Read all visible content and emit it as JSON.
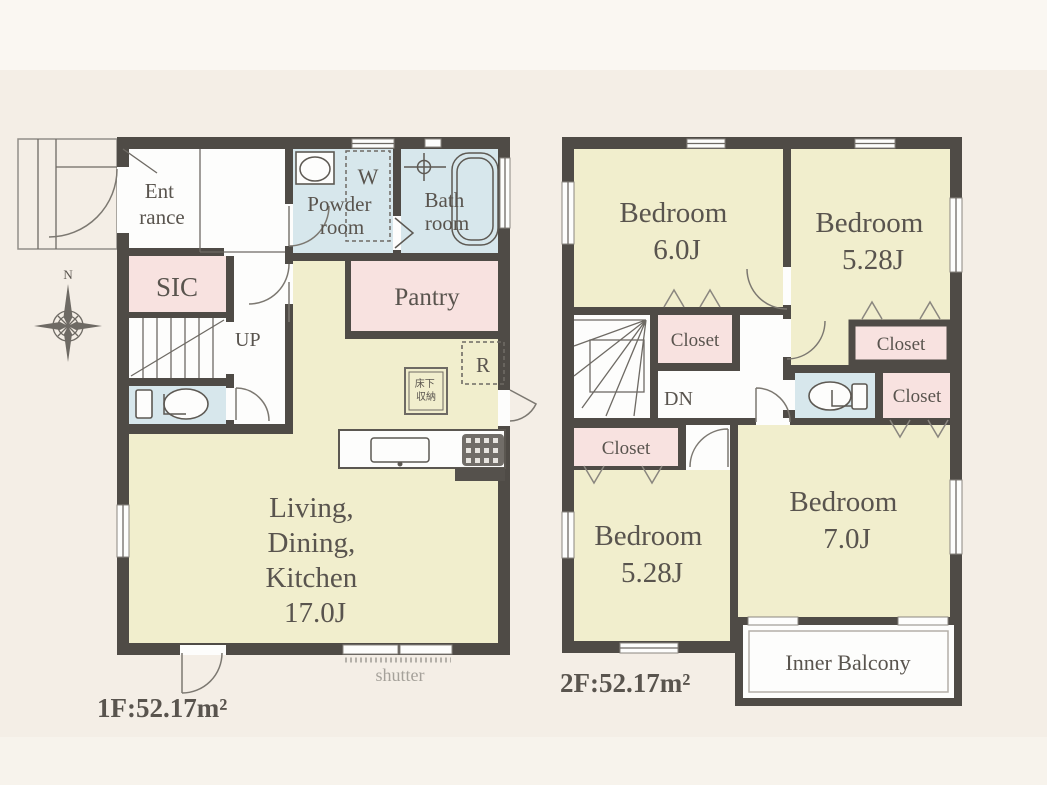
{
  "compass": {
    "north": "N"
  },
  "colors": {
    "wall": "#4f4b46",
    "room_yellow": "#f1eecd",
    "room_pink": "#f8e2e0",
    "room_blue": "#d7e7ec",
    "room_white": "#fdfdfc",
    "background": "#f4eee6",
    "text": "#59544e"
  },
  "fixtures": [
    "compass-rose",
    "toilet",
    "bathtub",
    "sink",
    "washer-space",
    "refrigerator-space",
    "kitchen-counter",
    "gas-stove",
    "floor-storage-hatch",
    "stairs",
    "porch-steps"
  ],
  "floor1": {
    "area_label": "1F:52.17m²",
    "entrance_line1": "Ent",
    "entrance_line2": "rance",
    "sic": "SIC",
    "up": "UP",
    "powder_line1": "Powder",
    "powder_line2": "room",
    "bath_line1": "Bath",
    "bath_line2": "room",
    "pantry": "Pantry",
    "washer": "W",
    "fridge": "R",
    "storage_line1": "床下",
    "storage_line2": "収納",
    "ldk_line1": "Living,",
    "ldk_line2": "Dining,",
    "ldk_line3": "Kitchen",
    "ldk_line4": "17.0J",
    "shutter": "shutter"
  },
  "floor2": {
    "area_label": "2F:52.17m²",
    "bedroom_nw_line1": "Bedroom",
    "bedroom_nw_line2": "6.0J",
    "bedroom_ne_line1": "Bedroom",
    "bedroom_ne_line2": "5.28J",
    "bedroom_sw_line1": "Bedroom",
    "bedroom_sw_line2": "5.28J",
    "bedroom_se_line1": "Bedroom",
    "bedroom_se_line2": "7.0J",
    "closet_mid": "Closet",
    "closet_ne": "Closet",
    "closet_e": "Closet",
    "closet_w": "Closet",
    "dn": "DN",
    "inner_balcony": "Inner Balcony"
  }
}
